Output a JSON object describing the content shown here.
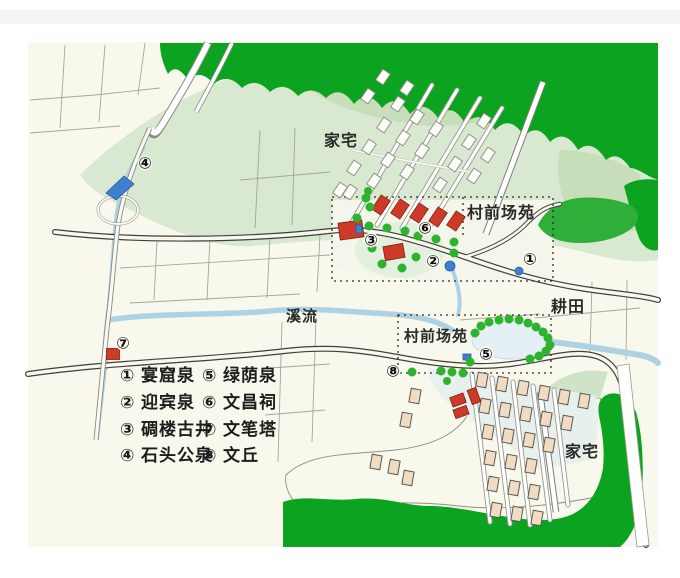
{
  "page": {
    "top_bar_color": "#f4f4f4",
    "background": "#ffffff"
  },
  "map": {
    "labels": {
      "top_houses": "家宅",
      "top_plaza": "村前场苑",
      "lower_plaza": "村前场苑",
      "farmland": "耕田",
      "stream": "溪流",
      "lower_houses": "家宅"
    },
    "marker_glyphs": [
      "①",
      "②",
      "③",
      "④",
      "⑤",
      "⑥",
      "⑦",
      "⑧"
    ]
  },
  "legend": {
    "items": [
      {
        "num": "①",
        "label": "宴窟泉"
      },
      {
        "num": "②",
        "label": "迎宾泉"
      },
      {
        "num": "③",
        "label": "碉楼古井"
      },
      {
        "num": "④",
        "label": "石头公泉"
      },
      {
        "num": "⑤",
        "label": "绿荫泉"
      },
      {
        "num": "⑥",
        "label": "文昌祠"
      },
      {
        "num": "⑦",
        "label": "文笔塔"
      },
      {
        "num": "⑧",
        "label": "文丘"
      }
    ]
  },
  "colors": {
    "cream": "#f8f8ec",
    "hill": "#d9e9d1",
    "hill_dark": "#c8deba",
    "forest": "#0ba31f",
    "blob": "#2fae3a",
    "tree": "#2db32d",
    "water": "#aed2e4",
    "pond": "#e4f0f5",
    "pale_band": "#cfe4c6",
    "plaza_bg": "#f4f6ec",
    "lower_bg": "#e7f0ec",
    "road_casing": "#3f3f3f",
    "road_fill": "#f8f8ec",
    "house_white": "#fcfcf8",
    "house_tan": "#f2dbc3",
    "building_red": "#cd3a28",
    "marker_blue": "#3f7fd1"
  }
}
